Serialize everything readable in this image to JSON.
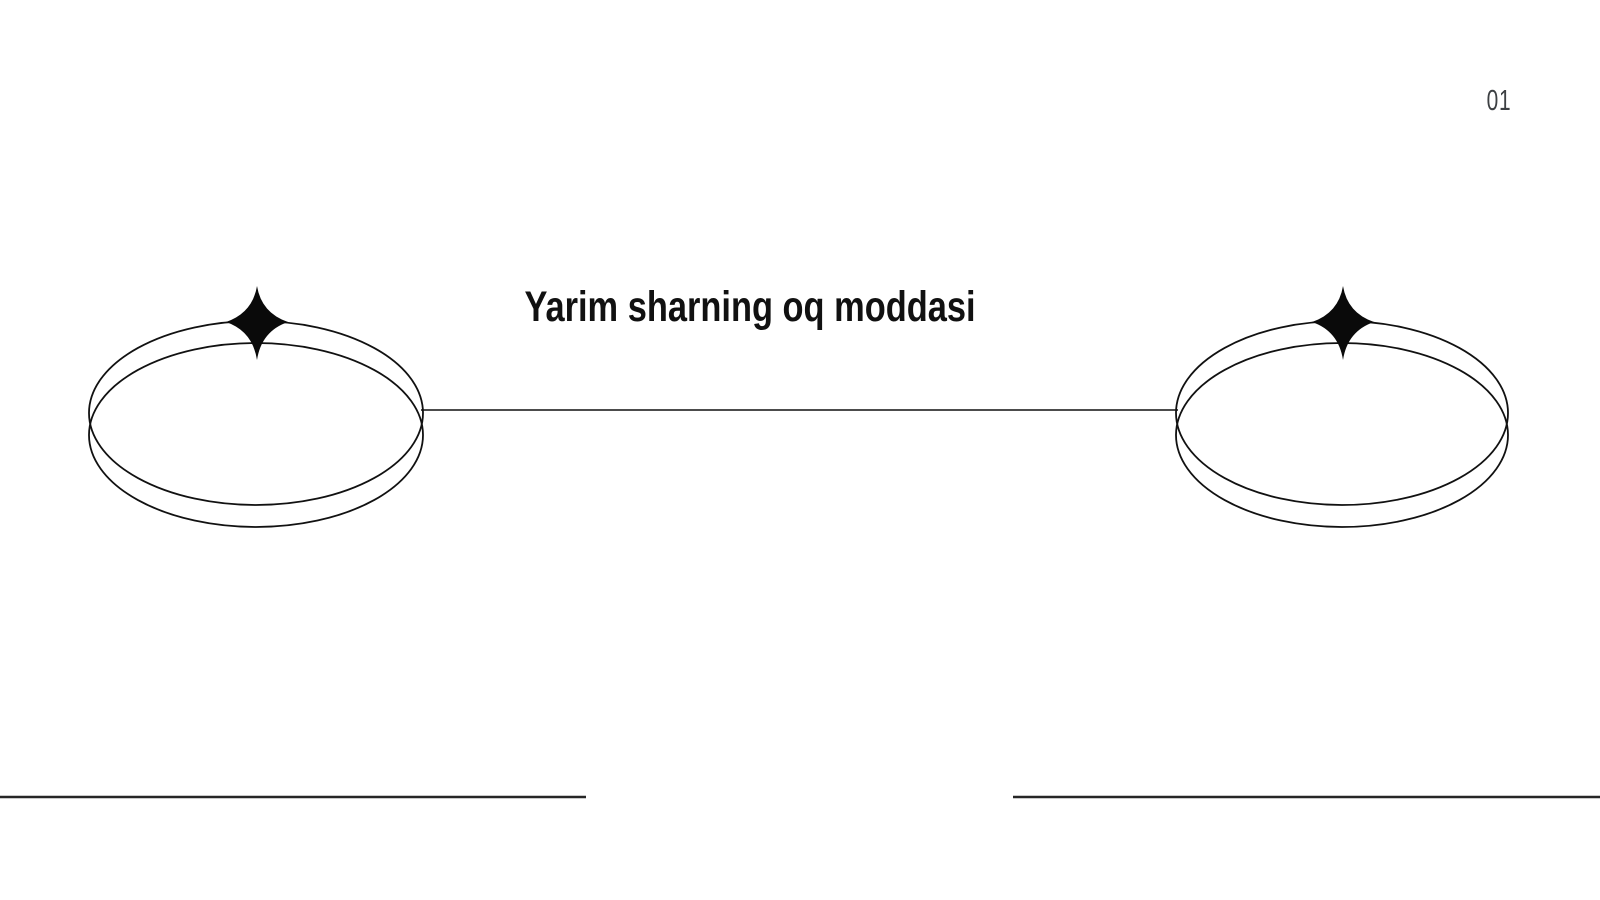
{
  "slide": {
    "title": "Yarim sharning oq moddasi",
    "page_number": "01"
  },
  "diagram": {
    "left_shape": {
      "name": "left-ellipse-ring",
      "decoration_icon": "four-point-sparkle-icon"
    },
    "right_shape": {
      "name": "right-ellipse-ring",
      "decoration_icon": "four-point-sparkle-icon"
    },
    "connector": {
      "type": "horizontal-line"
    },
    "footer_rule_count": 2
  },
  "colors": {
    "background": "#ffffff",
    "shape_stroke": "#111111",
    "sparkle_fill": "#0a0a0a",
    "connector_stroke": "#111111",
    "footer_rule": "#262626",
    "title_text": "#111111",
    "page_number_text": "#3d4043"
  }
}
